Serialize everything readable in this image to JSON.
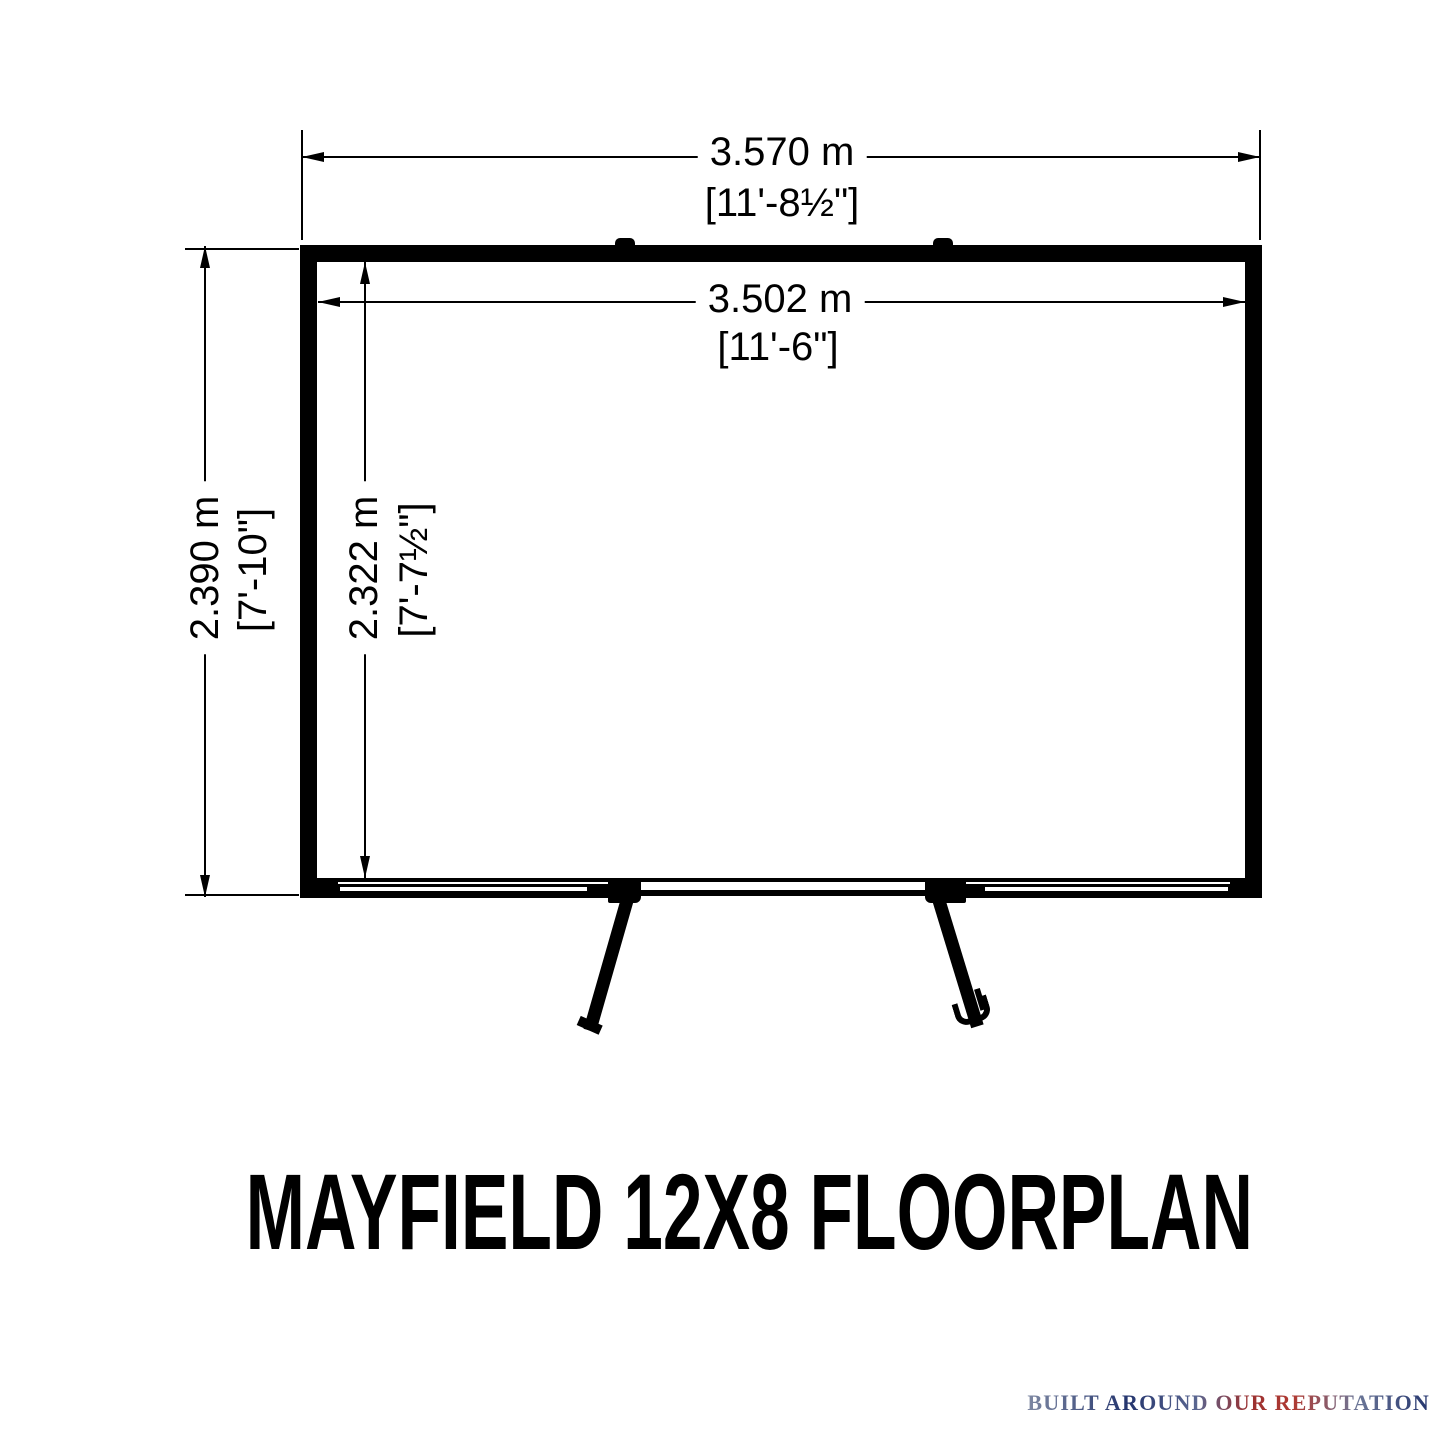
{
  "canvas": {
    "background": "#ffffff",
    "ink": "#000000"
  },
  "floorplan": {
    "title": "MAYFIELD 12X8 FLOORPLAN",
    "dimensions": {
      "outer_width": {
        "metric": "3.570 m",
        "imperial": "[11'-8½\"]"
      },
      "inner_width": {
        "metric": "3.502 m",
        "imperial": "[11'-6\"]"
      },
      "outer_depth": {
        "metric": "2.390 m",
        "imperial": "[7'-10\"]"
      },
      "inner_depth": {
        "metric": "2.322 m",
        "imperial": "[7'-7½\"]"
      }
    }
  },
  "logo": {
    "brand": "SHIRE",
    "letters": [
      "S",
      "H",
      "I",
      "R",
      "E"
    ],
    "tagline": "BUILT AROUND OUR REPUTATION",
    "colors": {
      "flag_red": "#c8202f",
      "flag_blue": "#1d3e92",
      "flag_silver": "#d8dee8"
    }
  }
}
